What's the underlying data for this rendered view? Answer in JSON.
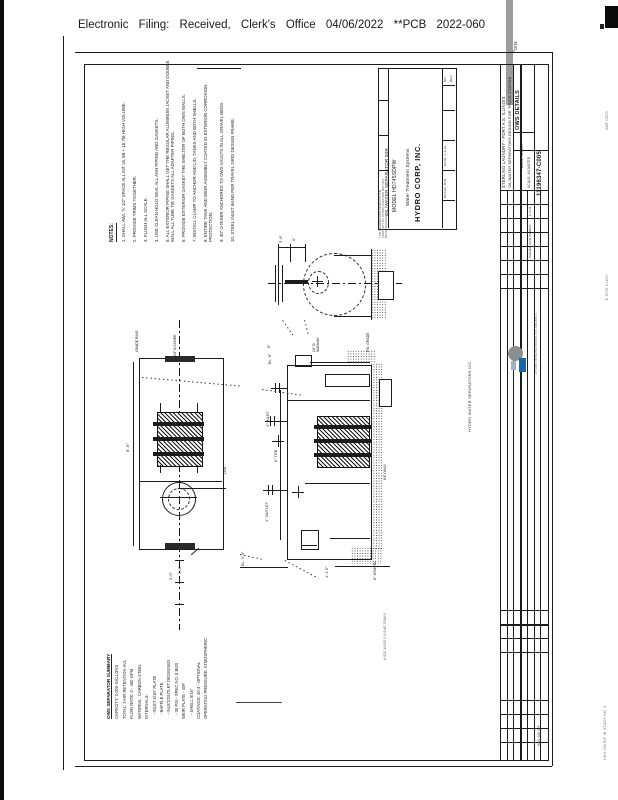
{
  "stamp": {
    "text": "Electronic Filing: Received, Clerk's Office 04/06/2022 **PCB 2022-060",
    "cut_fragment": "*ons"
  },
  "notes": {
    "heading": "NOTES:",
    "items": [
      "1. SHALL AWL 'A' 1/2\" SPACE ALL INT UL 5B + 10.7M HIGH VOLUME.",
      "2. PROVIDE TRIMS TOGETHER.",
      "3. FLUSH ALL SCALE.",
      "4. USE CLEAN HOLD SEAL ALL ASH PIPING AND GASKETS.",
      "5. ALL EXTERIOR PIPING SHALL GET THE REGULAR ALUMINUM JACKET AND DOUBLE WALL ALL TUBE TIE GASKETS ALL ADAPTER PIPING.",
      "6. PROVIDE EXTERIOR GASKET THE SHELTER OF BOTH OWS WALLS.",
      "7. INSTALL CLAMP TO ANCHOR AND LID, TANKS AND BOTH SHELLS.",
      "8. ENTIRE TANK AND WEIR ASSEMBLY COATED IN EXTERIOR CORROSION PROTECTION.",
      "9. 30\" O RISER ANCHORED TO OWS VAULTS IN ALL GRAVEL BEDS.",
      "10. STEEL INLET BAND PER TRAVEL GRID DESIGN FRAME."
    ]
  },
  "company_block": {
    "company": "HYDRO CORP, INC.",
    "tagline": "Water Treatment Systems",
    "model": "MODEL HD745SDPW",
    "product": "OIL/WATER SEPARATOR 50R",
    "proprietary": "THIS DRAWING AND DESIGN IS THE PROPERTY OF HYDRO CORP AND MAY NOT BE REPRODUCED",
    "no_label": "NO.",
    "rev_label": "REV",
    "date": "DATE: 1-4-21",
    "scale": "SCALE: NTS"
  },
  "strip": {
    "project_line1": "STERLING LAUNDRY - FORT A.S. ILLINOIS",
    "project_line2": "OIL/WATER SEPARATORS DESIGN FOR TRUCK STATION",
    "sheet_title": "OWS DETAILS",
    "insert_label": "B.O.B. INSERT",
    "scale_label": "SCALE: AS NOTED",
    "drawing_number": "11196347-C005",
    "rev_date": "1-4-21",
    "rev_note": "ISSUED FOR PERMIT",
    "dots": "............",
    "hydro_line": "HYDRO WATER SEPARATORS INC.",
    "logo_caption": "HYDRO INTERNATIONAL OF AMERICA",
    "bottom_fragment": "HNS 280 B/F"
  },
  "plan": {
    "grade_ring": "GRADE RING",
    "access": "24\" O COVER",
    "length": "8'-6\"",
    "dia": "DIA.",
    "dim_a": "3'-0\"",
    "dim_b": "1'-6\""
  },
  "end_view": {
    "dim_a": "3'-6\"",
    "dim_b": "6\"",
    "manway": "24\" O MANWAY",
    "grade": "FIN. GRADE",
    "inv": "8\""
  },
  "elevation": {
    "inlet": "4\" INLET",
    "tee": "6\" TEE",
    "outlet": "4\" OUTLET",
    "el_top": "EL. 8\"",
    "keyway": "KEYWAY",
    "dim_bottom": "4'-1.5\"",
    "gravel": "8\" GRAVEL",
    "fg": "EL. 5'-3\"",
    "side_note": "A 022 14150  5 0-6 60 TANKS"
  },
  "summary": {
    "heading": "OWS SEPARATOR SUMMARY",
    "lines": [
      "CAPACITY: 2,000 GALLONS",
      "TOTAL: 2-HR RETENTION AVL",
      "FLOW RATE: 0 - 450 GPM",
      "MATERIAL: CARBON STEEL",
      "INTERNALS:",
      "- INLET 5/16\" PLATE",
      "- BAFFLE PLATE",
      "- INLET/OUTLET DESIGNED",
      "- 30 PSI - SPEC NO. 5 BUS",
      "WEIR PLATE - 40F",
      "- SHELL 5/16\"",
      "COATINGS: 40-3 - OPTIONAL",
      "OPERATING PRESSURE: ATMOSPHERIC"
    ]
  },
  "edge": {
    "fragments": [
      "SMT-C005",
      "E SITE 14150",
      "HNS 280 B/F  IN STUDS NO. 2"
    ]
  },
  "colors": {
    "ink": "#1c1c1c",
    "logo_blue": "#1565a7",
    "stamp_bar_gray": "#9c9c9c"
  }
}
